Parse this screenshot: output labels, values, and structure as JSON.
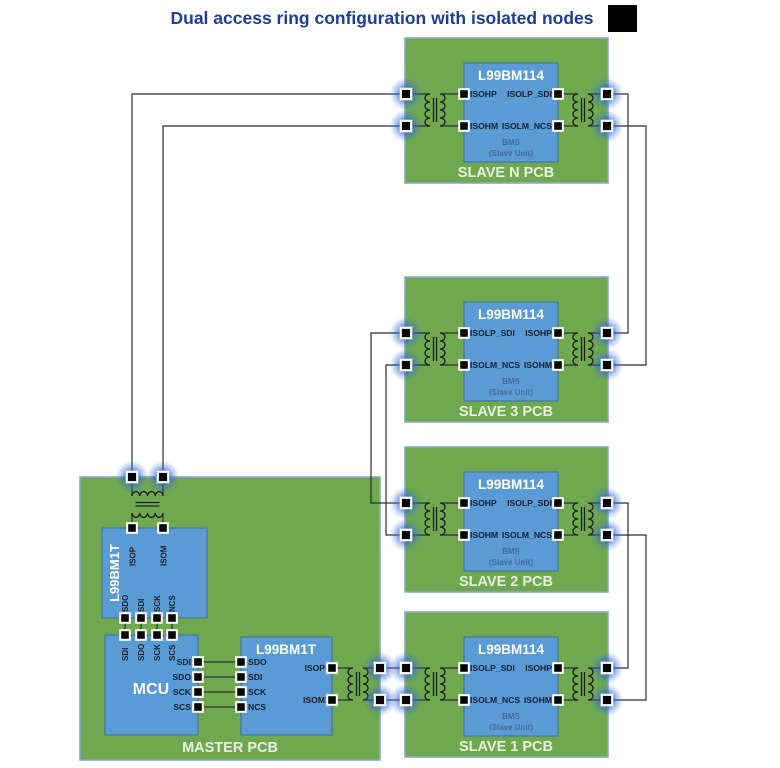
{
  "title": "Dual access ring configuration with isolated nodes",
  "colors": {
    "pcb_green": "#6fa84f",
    "chip_blue": "#5b9bd5",
    "title_blue": "#1e3e96",
    "pale_label": "#e7f1df",
    "node_glow_blue": "#2a5cc8"
  },
  "master": {
    "label": "MASTER PCB",
    "iso_transceiver": {
      "title": "L99BM1T",
      "pin_isop": "ISOP",
      "pin_isom": "ISOM",
      "spi_pins": [
        "SDO",
        "SDI",
        "SCK",
        "NCS"
      ]
    },
    "mcu": {
      "title": "MCU",
      "top_spi_pins": [
        "SDI",
        "SDO",
        "SCK",
        "SCS"
      ],
      "right_spi_pins": [
        "SDI",
        "SDO",
        "SCK",
        "SCS"
      ]
    },
    "ring_transceiver": {
      "title": "L99BM1T",
      "spi_pins": [
        "SDO",
        "SDI",
        "SCK",
        "NCS"
      ],
      "pin_isop": "ISOP",
      "pin_isom": "ISOM"
    }
  },
  "slaves": [
    {
      "label": "SLAVE N PCB",
      "chip": "L99BM114",
      "left_pin_top": "ISOHP",
      "left_pin_bottom": "ISOHM",
      "right_pin_top": "ISOLP_SDI",
      "right_pin_bottom": "ISOLM_NCS",
      "bms_line1": "BMS",
      "bms_line2": "(Slave Unit)"
    },
    {
      "label": "SLAVE 3 PCB",
      "chip": "L99BM114",
      "left_pin_top": "ISOLP_SDI",
      "left_pin_bottom": "ISOLM_NCS",
      "right_pin_top": "ISOHP",
      "right_pin_bottom": "ISOHM",
      "bms_line1": "BMS",
      "bms_line2": "(Slave Unit)"
    },
    {
      "label": "SLAVE 2 PCB",
      "chip": "L99BM114",
      "left_pin_top": "ISOHP",
      "left_pin_bottom": "ISOHM",
      "right_pin_top": "ISOLP_SDI",
      "right_pin_bottom": "ISOLM_NCS",
      "bms_line1": "BMS",
      "bms_line2": "(Slave Unit)"
    },
    {
      "label": "SLAVE 1 PCB",
      "chip": "L99BM114",
      "left_pin_top": "ISOLP_SDI",
      "left_pin_bottom": "ISOLM_NCS",
      "right_pin_top": "ISOHP",
      "right_pin_bottom": "ISOHM",
      "bms_line1": "BMS",
      "bms_line2": "(Slave Unit)"
    }
  ]
}
